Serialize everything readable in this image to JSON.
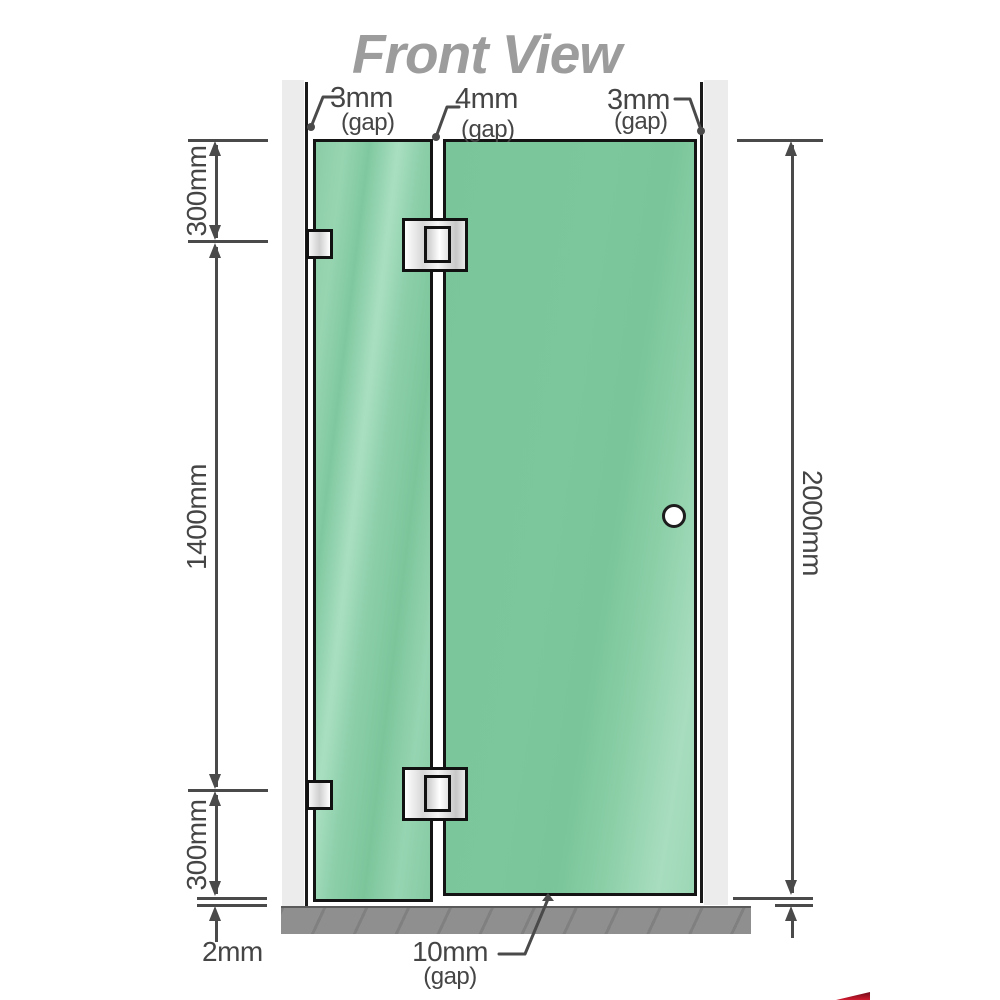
{
  "title": "Front View",
  "colors": {
    "glass_green": "#7cc79c",
    "glass_highlight": "#a8ddbf",
    "wall_gray": "#ececec",
    "floor_gray": "#8f8f8f",
    "outline_black": "#141414",
    "dimension_gray": "#4a4a4a",
    "title_gray": "#9c9c9c",
    "hardware_silver": "#e9e9e9",
    "watermark_red": "#d11a2e"
  },
  "dimensions": {
    "top_gaps": [
      {
        "value": "3mm",
        "note": "(gap)"
      },
      {
        "value": "4mm",
        "note": "(gap)"
      },
      {
        "value": "3mm",
        "note": "(gap)"
      }
    ],
    "left_segments": [
      {
        "label": "300mm"
      },
      {
        "label": "1400mm"
      },
      {
        "label": "300mm"
      }
    ],
    "total_height": "2000mm",
    "floor_gap": "2mm",
    "bottom_gap": {
      "value": "10mm",
      "note": "(gap)"
    }
  },
  "parts": [
    "left-wall-channel",
    "right-wall-channel",
    "fixed-glass-panel",
    "door-glass-panel",
    "glass-hinge-top",
    "glass-hinge-bottom",
    "wall-bracket-top",
    "wall-bracket-bottom",
    "door-knob",
    "floor-base"
  ]
}
